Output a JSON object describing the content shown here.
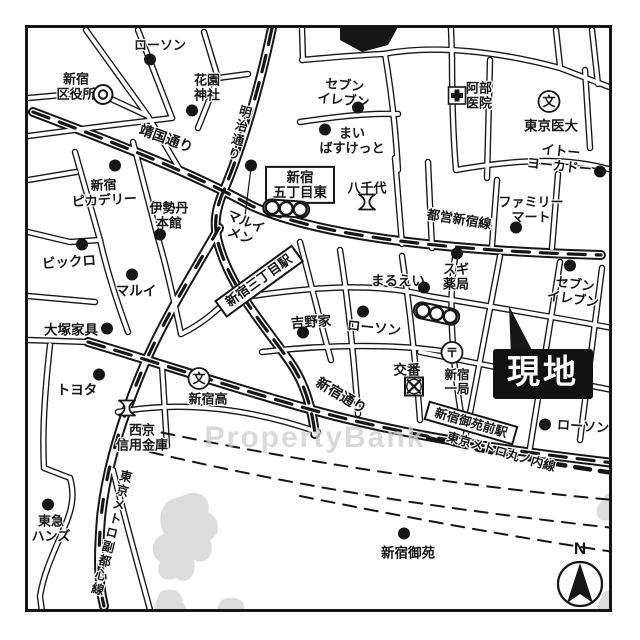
{
  "map": {
    "watermark": "PropertyBank",
    "compass": {
      "label": "N",
      "x": 580,
      "y": 584
    },
    "colors": {
      "ink": "#161616",
      "bg": "#ffffff",
      "site_bg": "#111111",
      "site_text": "#ffffff",
      "park_gray": "#bfbfbf",
      "watermark_gray": "#cdcdcd"
    },
    "labels": [
      {
        "id": "lawson-top",
        "text": "ローソン",
        "x": 160,
        "y": 46,
        "r": 0,
        "fs": 13,
        "style": "poi"
      },
      {
        "id": "ward-office",
        "text": "新宿\n区役所",
        "x": 76,
        "y": 87,
        "r": 0,
        "fs": 13,
        "style": "poi"
      },
      {
        "id": "hanazono-shrine",
        "text": "花園\n神社",
        "x": 207,
        "y": 88,
        "r": 0,
        "fs": 13,
        "style": "poi"
      },
      {
        "id": "yasukuni-dori",
        "text": "靖国通り",
        "x": 166,
        "y": 139,
        "r": 20,
        "fs": 14,
        "style": "poi"
      },
      {
        "id": "meiji-dori",
        "text": "明治通り",
        "x": 238,
        "y": 133,
        "r": 15,
        "fs": 12.5,
        "style": "vroad"
      },
      {
        "id": "seven-top",
        "text": "セブン\nイレブン",
        "x": 344,
        "y": 93,
        "r": 5,
        "fs": 13,
        "style": "poi"
      },
      {
        "id": "maibasket",
        "text": "まい\nばすけっと",
        "x": 352,
        "y": 141,
        "r": 0,
        "fs": 13,
        "style": "poi"
      },
      {
        "id": "abe-clinic",
        "text": "阿部\n医院",
        "x": 479,
        "y": 96,
        "r": 0,
        "fs": 13,
        "style": "poi"
      },
      {
        "id": "tokyo-idai",
        "text": "東京医大",
        "x": 551,
        "y": 126,
        "r": 0,
        "fs": 13.5,
        "style": "poi"
      },
      {
        "id": "ito-yokado",
        "text": "イトー\nヨーカドー",
        "x": 560,
        "y": 159,
        "r": 6,
        "fs": 13,
        "style": "poi"
      },
      {
        "id": "gochome-higashi",
        "text": "新宿\n五丁目東",
        "x": 300,
        "y": 185,
        "r": 0,
        "fs": 13.5,
        "style": "boxed"
      },
      {
        "id": "yachiyo",
        "text": "八千代",
        "x": 367,
        "y": 189,
        "r": 0,
        "fs": 13,
        "style": "poi"
      },
      {
        "id": "toei-shinjuku-line",
        "text": "都営新宿線",
        "x": 459,
        "y": 220,
        "r": 9,
        "fs": 13,
        "style": "poi"
      },
      {
        "id": "familymart",
        "text": "ファミリー\nマート",
        "x": 531,
        "y": 210,
        "r": 0,
        "fs": 13,
        "style": "poi"
      },
      {
        "id": "piccadilly",
        "text": "新宿\nピカデリー",
        "x": 104,
        "y": 193,
        "r": -3,
        "fs": 13,
        "style": "poi"
      },
      {
        "id": "isetan",
        "text": "伊勢丹\n本館",
        "x": 169,
        "y": 216,
        "r": 0,
        "fs": 13,
        "style": "poi"
      },
      {
        "id": "marui-men",
        "text": "マルイ\nメン",
        "x": 243,
        "y": 229,
        "r": 22,
        "fs": 13,
        "style": "poi"
      },
      {
        "id": "bicqlo",
        "text": "ビックロ",
        "x": 69,
        "y": 262,
        "r": -4,
        "fs": 13.5,
        "style": "poi"
      },
      {
        "id": "marui",
        "text": "マルイ",
        "x": 136,
        "y": 291,
        "r": 0,
        "fs": 13.5,
        "style": "poi"
      },
      {
        "id": "sanchome-station",
        "text": "新宿三丁目駅",
        "x": 259,
        "y": 281,
        "r": -36,
        "fs": 13,
        "style": "station"
      },
      {
        "id": "maruei",
        "text": "まるえい",
        "x": 398,
        "y": 281,
        "r": 0,
        "fs": 13.5,
        "style": "poi"
      },
      {
        "id": "sugi-pharmacy",
        "text": "スギ\n薬局",
        "x": 456,
        "y": 277,
        "r": 0,
        "fs": 13,
        "style": "poi"
      },
      {
        "id": "seven-right",
        "text": "セブン\nイレブン",
        "x": 574,
        "y": 292,
        "r": 8,
        "fs": 13,
        "style": "poi"
      },
      {
        "id": "otsuka-kagu",
        "text": "大塚家具",
        "x": 71,
        "y": 330,
        "r": 0,
        "fs": 13.5,
        "style": "poi"
      },
      {
        "id": "toyota",
        "text": "トヨタ",
        "x": 77,
        "y": 390,
        "r": 0,
        "fs": 13.5,
        "style": "poi"
      },
      {
        "id": "yoshinoya",
        "text": "吉野家",
        "x": 311,
        "y": 322,
        "r": -4,
        "fs": 13.5,
        "style": "poi"
      },
      {
        "id": "lawson-mid",
        "text": "ローソン",
        "x": 374,
        "y": 328,
        "r": 6,
        "fs": 13.5,
        "style": "poi"
      },
      {
        "id": "koban",
        "text": "交番",
        "x": 407,
        "y": 370,
        "r": 0,
        "fs": 13.5,
        "style": "poi"
      },
      {
        "id": "shinjuku-post",
        "text": "新宿\n一局",
        "x": 457,
        "y": 382,
        "r": 0,
        "fs": 12.5,
        "style": "poi"
      },
      {
        "id": "genchi-site",
        "text": "現地",
        "x": 543,
        "y": 374,
        "r": 0,
        "fs": 33,
        "style": "site"
      },
      {
        "id": "shinjuku-dori",
        "text": "新宿通り",
        "x": 341,
        "y": 396,
        "r": 31,
        "fs": 14,
        "style": "poi"
      },
      {
        "id": "shinjuku-high",
        "text": "新宿高",
        "x": 208,
        "y": 400,
        "r": 0,
        "fs": 13,
        "style": "poi"
      },
      {
        "id": "saikyo-shinkin",
        "text": "西京\n信用金庫",
        "x": 142,
        "y": 438,
        "r": 0,
        "fs": 13,
        "style": "poi"
      },
      {
        "id": "gyoemmae-station",
        "text": "新宿御苑前駅",
        "x": 471,
        "y": 423,
        "r": 16,
        "fs": 12.5,
        "style": "station"
      },
      {
        "id": "marunouchi-line",
        "text": "東京メトロ丸ノ内線",
        "x": 501,
        "y": 452,
        "r": 16,
        "fs": 12.5,
        "style": "poi"
      },
      {
        "id": "lawson-br",
        "text": "ローソン",
        "x": 583,
        "y": 427,
        "r": 4,
        "fs": 13,
        "style": "poi"
      },
      {
        "id": "fukutoshin-line",
        "text": "東京メトロ副都心線",
        "x": 110,
        "y": 533,
        "r": 14,
        "fs": 12.5,
        "style": "vroad"
      },
      {
        "id": "tokyu-hands",
        "text": "東急\nハンズ",
        "x": 51,
        "y": 529,
        "r": 0,
        "fs": 13,
        "style": "poi"
      },
      {
        "id": "shinjuku-gyoen",
        "text": "新宿御苑",
        "x": 408,
        "y": 553,
        "r": 0,
        "fs": 13.5,
        "style": "poi"
      }
    ],
    "icons": [
      {
        "type": "dot",
        "x": 150,
        "y": 62
      },
      {
        "type": "dot",
        "x": 192,
        "y": 113
      },
      {
        "type": "dot",
        "x": 358,
        "y": 110
      },
      {
        "type": "dot",
        "x": 325,
        "y": 132
      },
      {
        "type": "dot",
        "x": 600,
        "y": 174
      },
      {
        "type": "dot",
        "x": 516,
        "y": 230
      },
      {
        "type": "dot",
        "x": 115,
        "y": 168
      },
      {
        "type": "dot",
        "x": 160,
        "y": 237
      },
      {
        "type": "dot",
        "x": 82,
        "y": 247
      },
      {
        "type": "dot",
        "x": 132,
        "y": 277
      },
      {
        "type": "dot",
        "x": 251,
        "y": 168
      },
      {
        "type": "dot",
        "x": 424,
        "y": 290
      },
      {
        "type": "dot",
        "x": 457,
        "y": 256
      },
      {
        "type": "dot",
        "x": 570,
        "y": 268
      },
      {
        "type": "dot",
        "x": 107,
        "y": 331
      },
      {
        "type": "dot",
        "x": 99,
        "y": 377
      },
      {
        "type": "dot",
        "x": 303,
        "y": 335
      },
      {
        "type": "dot",
        "x": 363,
        "y": 314
      },
      {
        "type": "dot",
        "x": 545,
        "y": 427
      },
      {
        "type": "dot",
        "x": 48,
        "y": 507
      },
      {
        "type": "dot",
        "x": 404,
        "y": 536
      },
      {
        "type": "double-circle-icon",
        "x": 103,
        "y": 97
      },
      {
        "type": "hospital-icon",
        "x": 457,
        "y": 98
      },
      {
        "type": "school-icon",
        "x": 549,
        "y": 104,
        "glyph": "文"
      },
      {
        "type": "school-icon",
        "x": 199,
        "y": 381,
        "glyph": "文"
      },
      {
        "type": "bank-icon",
        "x": 367,
        "y": 206
      },
      {
        "type": "bank-icon",
        "x": 127,
        "y": 412
      },
      {
        "type": "post-office-icon",
        "x": 452,
        "y": 355,
        "glyph": "〒"
      },
      {
        "type": "police-icon",
        "x": 414,
        "y": 389
      },
      {
        "type": "traffic-signal-icon",
        "x": 286,
        "y": 211,
        "r": 4
      },
      {
        "type": "traffic-signal-icon",
        "x": 436,
        "y": 316,
        "r": 12
      }
    ]
  }
}
